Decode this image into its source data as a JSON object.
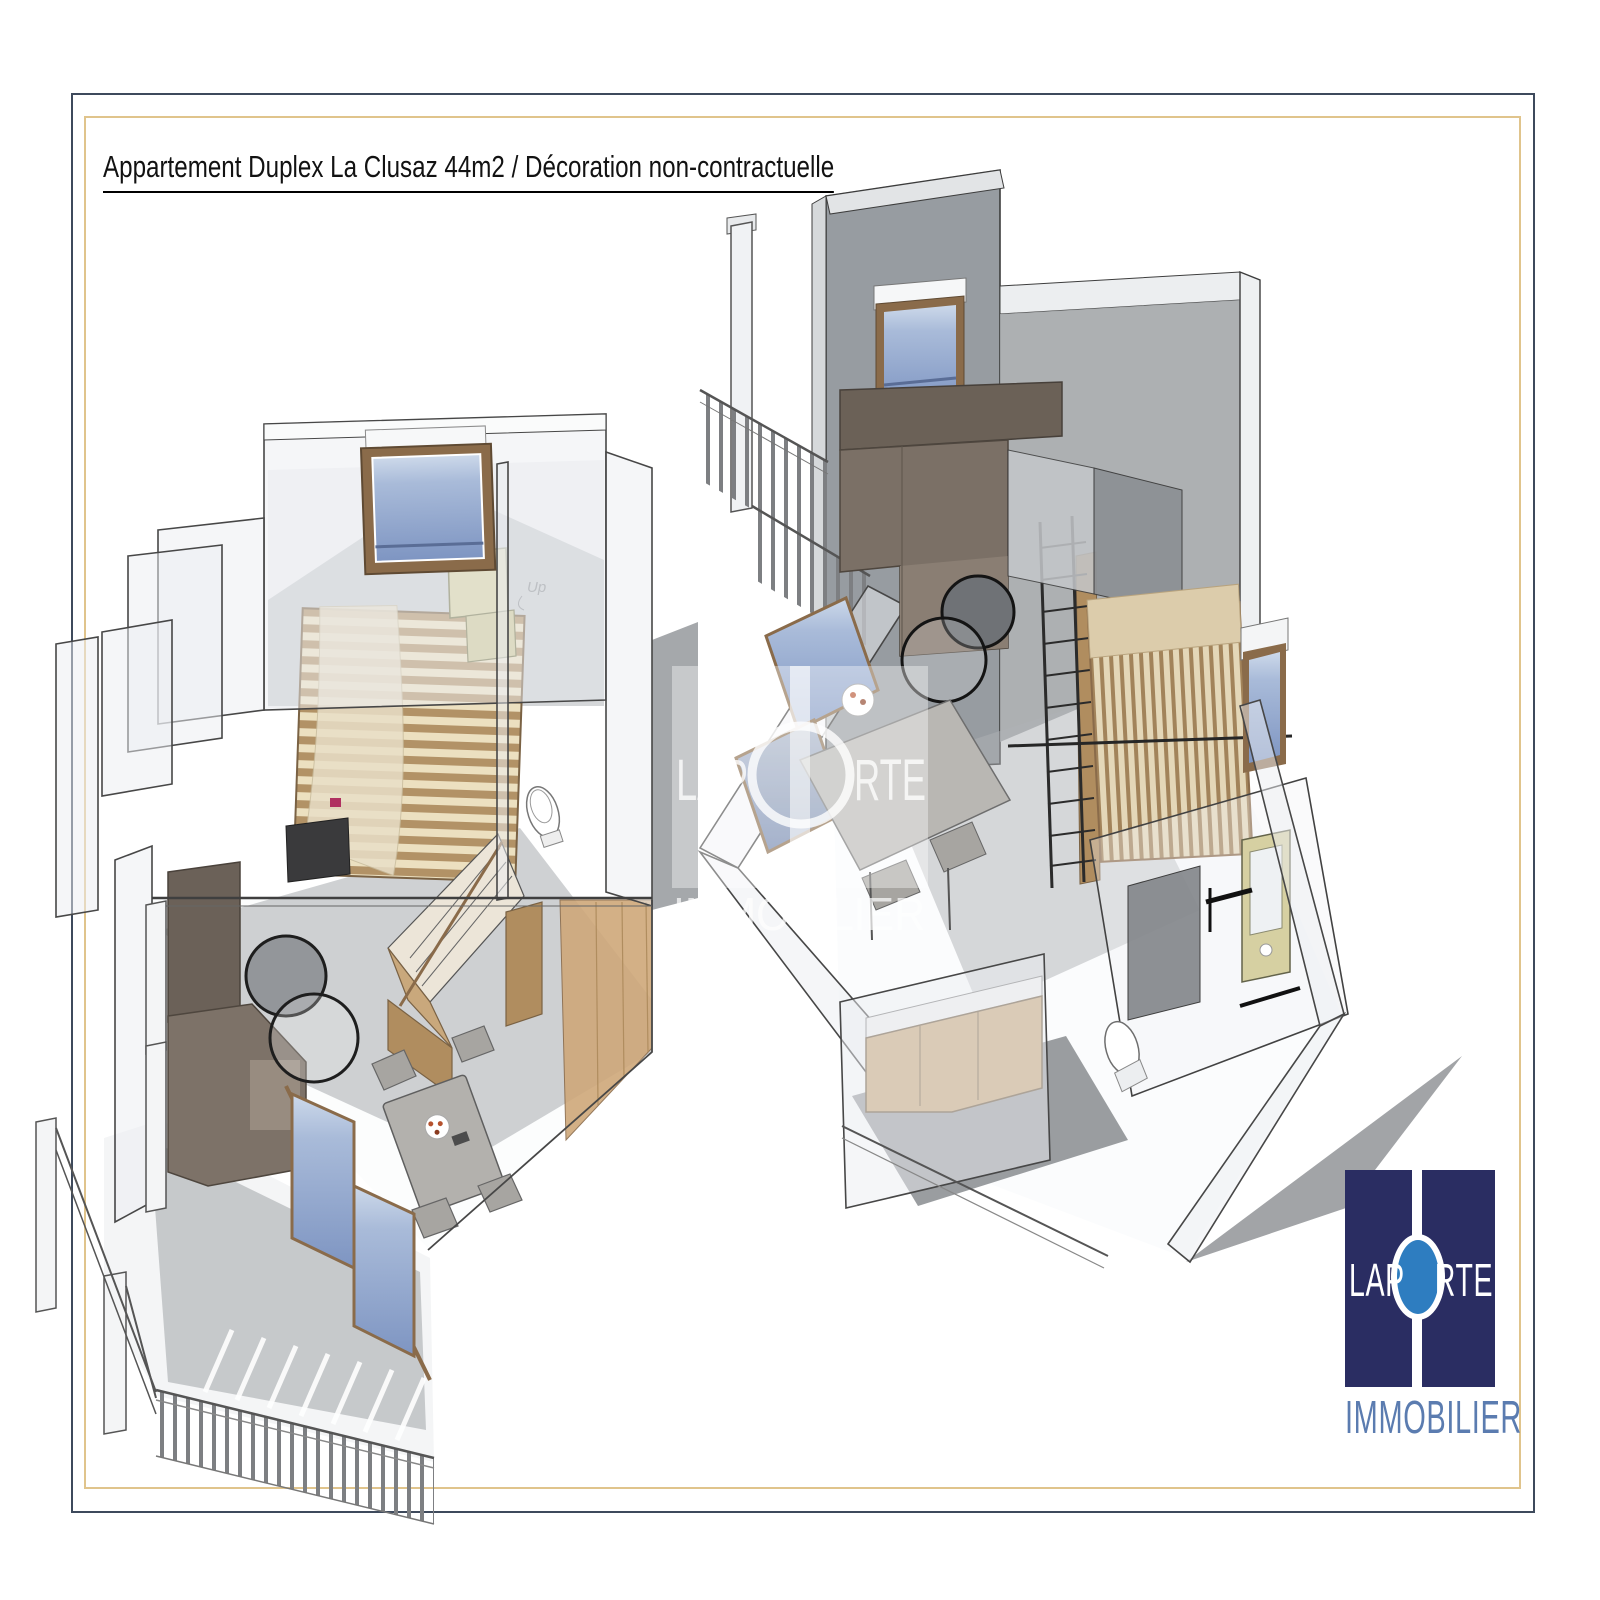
{
  "header": {
    "title": "Appartement Duplex La Clusaz 44m2 / Décoration non-contractuelle"
  },
  "illustration": {
    "type": "3d-floor-plans",
    "left_plan": {
      "stairs_label": "Up"
    },
    "colors": {
      "wall_fill": "#eceef1",
      "wall_stroke": "#474747",
      "dark_back_wall": "#979ca1",
      "shadow": "#a8abae",
      "window_glass_light": "#c7d3e6",
      "window_glass_dark": "#7e95c2",
      "wood_frame": "#8a6b4a",
      "wood_floor": "#c9a87c",
      "bed_slats": "#b29266",
      "sofa": "#7b7066",
      "khaki_furniture": "#d6d0a2",
      "coffee_table_stroke": "#1e1e1e"
    }
  },
  "watermark": {
    "line1_left": "LAP",
    "line1_right": "RTE",
    "line2": "IMMOBILIER",
    "opacity": 0.45
  },
  "frame": {
    "outer_border_color": "#3e4a5c",
    "inner_border_color": "#e0c48c"
  },
  "logo": {
    "brand_full": "LAPORTE",
    "brand_left": "LAP",
    "brand_right": "RTE",
    "subtitle": "IMMOBILIER",
    "square_color": "#2a2d62",
    "o_color": "#2e7dc0",
    "subtitle_color": "#5b7cb0"
  }
}
